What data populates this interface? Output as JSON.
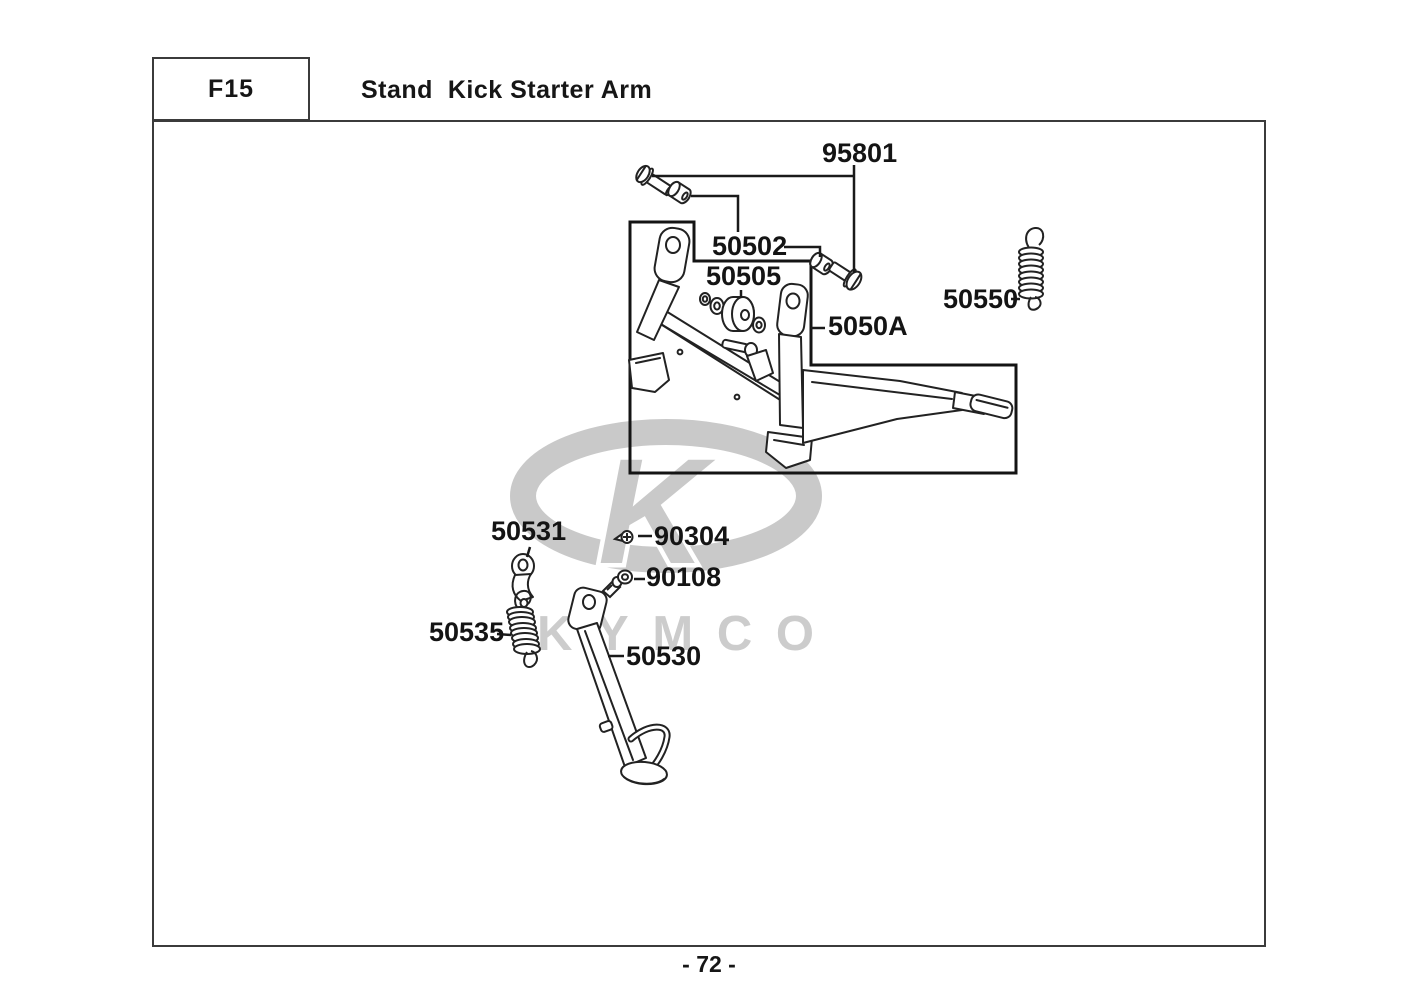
{
  "header": {
    "section_code": "F15",
    "title": "Stand  Kick Starter Arm"
  },
  "footer": {
    "page_number": "- 72 -"
  },
  "watermark": {
    "brand_letter": "K",
    "brand_text": "KYMCO"
  },
  "diagram": {
    "parts": [
      {
        "number": "95801"
      },
      {
        "number": "50502"
      },
      {
        "number": "50505"
      },
      {
        "number": "50550"
      },
      {
        "number": "5050A"
      },
      {
        "number": "50531"
      },
      {
        "number": "90304"
      },
      {
        "number": "90108"
      },
      {
        "number": "50535"
      },
      {
        "number": "50530"
      }
    ]
  }
}
